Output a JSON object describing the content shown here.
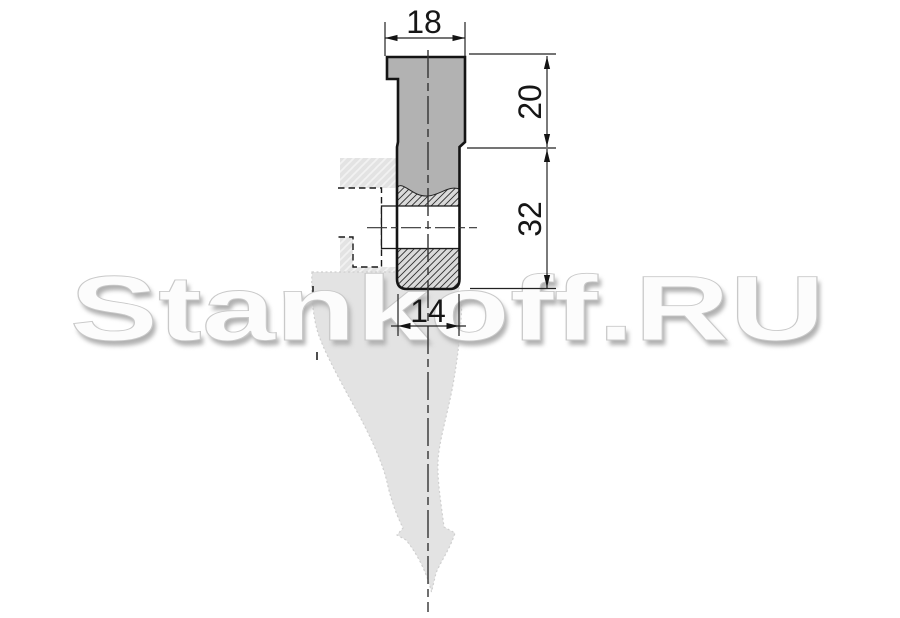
{
  "watermark": {
    "text": "Stankoff.RU"
  },
  "drawing": {
    "type": "technical-drawing-press-brake-punch-section",
    "dimensions": {
      "shank_width": {
        "value": "18",
        "position": "top",
        "orientation": "horizontal"
      },
      "shank_height": {
        "value": "20",
        "position": "right-upper",
        "orientation": "vertical"
      },
      "body_height": {
        "value": "32",
        "position": "right-lower",
        "orientation": "vertical"
      },
      "tip_width": {
        "value": "14",
        "position": "bottom",
        "orientation": "horizontal"
      }
    },
    "colors": {
      "background": "#ffffff",
      "punch_fill": "#b2b2b2",
      "section_hatch_bg": "#dadada",
      "section_hatch_line": "#2e2e2e",
      "ghost_fill": "#e3e3e3",
      "line": "#1a1a1a",
      "watermark_shadow": "#b1b1b1"
    }
  }
}
